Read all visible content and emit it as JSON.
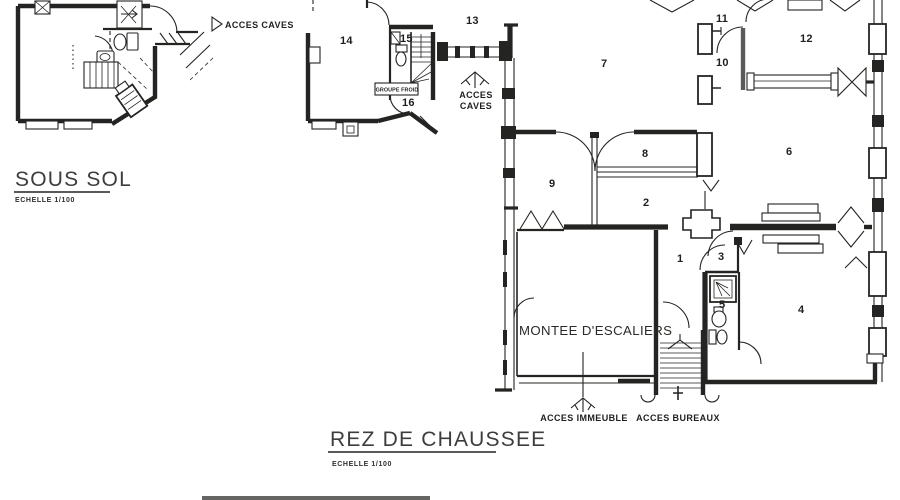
{
  "colors": {
    "paper": "#ffffff",
    "ink": "#242422",
    "title_ink": "#3d3d3b"
  },
  "sous_sol": {
    "title": "SOUS SOL",
    "scale_label": "ECHELLE  1/100",
    "acces_caves_label": "ACCES CAVES"
  },
  "rdc": {
    "title": "REZ DE CHAUSSEE",
    "scale_label": "ECHELLE  1/100",
    "groupe_froid_label": "GROUPE FROID",
    "acces_caves_line1": "ACCES",
    "acces_caves_line2": "CAVES",
    "montee_escaliers_label": "MONTEE D'ESCALIERS",
    "acces_immeuble_label": "ACCES IMMEUBLE",
    "acces_bureaux_label": "ACCES BUREAUX",
    "rooms": {
      "r1": "1",
      "r2": "2",
      "r3": "3",
      "r4": "4",
      "r5": "5",
      "r6": "6",
      "r7": "7",
      "r8": "8",
      "r9": "9",
      "r10": "10",
      "r11": "11",
      "r12": "12",
      "r13": "13",
      "r14": "14",
      "r15": "15",
      "r16": "16"
    }
  }
}
